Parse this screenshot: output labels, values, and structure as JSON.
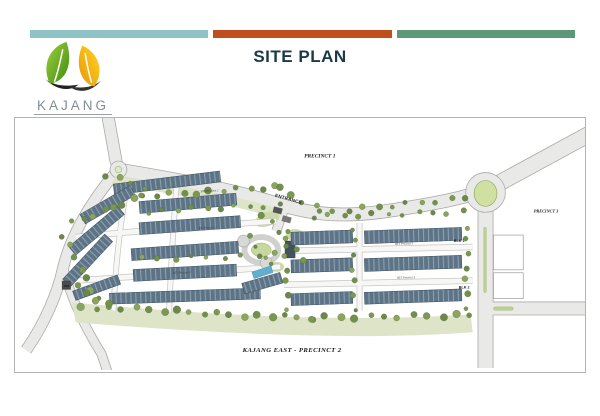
{
  "header": {
    "bars": [
      {
        "name": "teal-bar",
        "color": "#8fc3c6"
      },
      {
        "name": "orange-bar",
        "color": "#c04f1e"
      },
      {
        "name": "green-bar",
        "color": "#5d9879"
      }
    ],
    "title": "SITE PLAN",
    "title_color": "#1b3a46"
  },
  "logo": {
    "brand": "KAJANG",
    "sub": "E A S T",
    "leaf_green": "#5aa321",
    "leaf_yellow": "#f4b90f"
  },
  "plan": {
    "region_labels": {
      "precinct1": "PRECINCT 1",
      "precinct3": "PRECINCT 3",
      "caption": "KAJANG EAST - PRECINCT 2"
    },
    "poi_labels": {
      "entrance": "ENTRANCE",
      "blk1": "BLK 1",
      "blk2": "BLK 2",
      "tnb": "TNB"
    },
    "street_labels": [
      "BT5 Precinct 2",
      "BT5 Precinct 2",
      "BT5 Precinct 2",
      "BT5 Precinct 2",
      "BT5 Precinct 2"
    ],
    "colors": {
      "road": "#e9e9e7",
      "road_edge": "#a9a9a7",
      "roof": "#5d7487",
      "roof_light": "#8ca0b0",
      "tree": "#7c974f",
      "landscape": "#dde4c8",
      "pool": "#5fb0cf",
      "island_green": "#cfe0a0"
    }
  }
}
